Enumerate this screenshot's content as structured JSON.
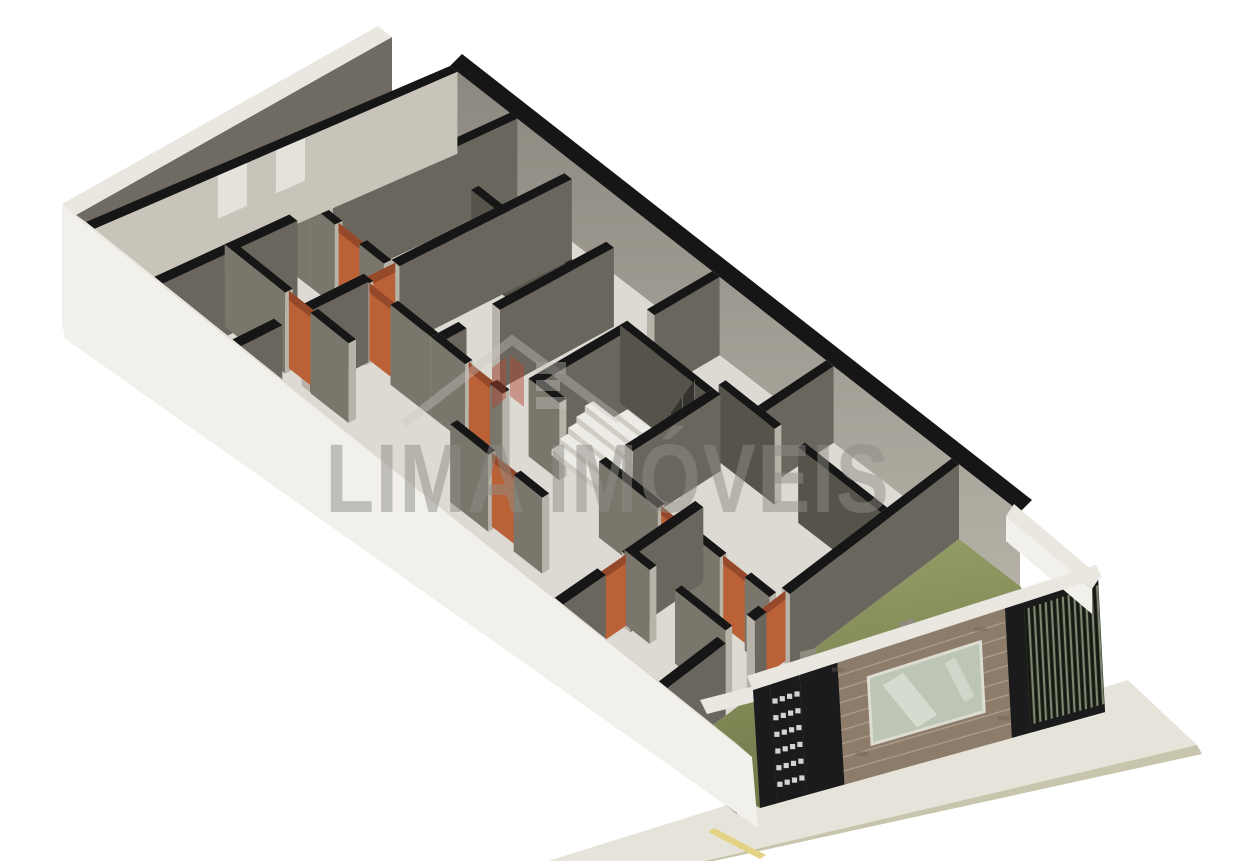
{
  "meta": {
    "description": "Isometric 3D architectural floor plan render of a long narrow building with interior walls, orange doors, central staircase, street-side garage facade with brick wall, slatted gate and sidewalk",
    "view": "isometric-3d-floor-plan"
  },
  "watermark": {
    "text": "LIMA IMÓVEIS",
    "logo": "house-logo",
    "x": 608,
    "y": 512,
    "size": 97,
    "text_length": 565
  },
  "colors": {
    "bg": "#ffffff",
    "wall_top": "#161616",
    "wall_face_dark": "#6a665d",
    "wall_face_med": "#7a766c",
    "wall_face_deep": "#56534b",
    "wall_face_light": "#c8c4ba",
    "wall_cap": "#b7b3a9",
    "ne_face_top": "#8d887f",
    "ne_face_bottom": "#b4b0a6",
    "floor": "#dcdad2",
    "side_yard": "#d5d3cb",
    "shell_band": "#e9e7e0",
    "shell_outer": "#f2f0ea",
    "shell_inner": "#6e6a61",
    "boundary_inner": "#6f6b63",
    "boundary_notch": "#e6e4dd",
    "door_orange": "#bb6138",
    "door_orange_dark": "#96492a",
    "stair_tread": "#edebe5",
    "stair_riser": "#cfccc4",
    "railing": "rgba(42,42,38,0.78)",
    "grass_light": "#9aa36b",
    "grass_dark": "#6e7747",
    "garage_band": "#e9e7e0",
    "garage_column": "#8f8b81",
    "brick_base": "#8d7c69",
    "brick_mortar": "#b7a897",
    "brick_dark": "#6f5f4e",
    "glass": "#ccd3c9",
    "glass_streak": "#f4f6f1",
    "window_frame": "#eff0ea",
    "facade_black": "#1b1b1e",
    "gate_bg": "#262b22",
    "gate_slat_light": "#7c856f",
    "gate_slat_dark": "#14180f",
    "walk_deck": "#e6e4da",
    "walk_curb": "#c7c5ab",
    "road_yellow": "#e2d386",
    "watermark_gray": "#8f8d87",
    "watermark_red": "#b14531",
    "watermark_light": "#c9c7c1"
  },
  "scene": {
    "projection": {
      "N": [
        450,
        66
      ],
      "E": [
        1020,
        512
      ],
      "W": [
        86,
        222
      ],
      "S": [
        737,
        744
      ],
      "hN": 82,
      "hE": 74,
      "hW": 84,
      "hS": 70
    },
    "shell": {
      "ne_band": [
        [
          462,
          54
        ],
        [
          1032,
          500
        ],
        [
          1020,
          512
        ],
        [
          450,
          66
        ]
      ],
      "boundary_band": [
        [
          62,
          204
        ],
        [
          378,
          26
        ],
        [
          392,
          37
        ],
        [
          76,
          215
        ]
      ],
      "boundary_face": [
        [
          76,
          215
        ],
        [
          392,
          37
        ],
        [
          392,
          121
        ],
        [
          76,
          299
        ]
      ],
      "boundary_notch": [
        [
          296,
          150
        ],
        [
          328,
          134
        ],
        [
          328,
          154
        ],
        [
          296,
          170
        ]
      ],
      "boundary_outer": [
        [
          62,
          204
        ],
        [
          76,
          215
        ],
        [
          76,
          299
        ],
        [
          62,
          331
        ]
      ],
      "side_yard": [
        [
          76,
          299
        ],
        [
          392,
          121
        ],
        [
          450,
          66
        ],
        [
          86,
          222
        ]
      ],
      "left_band": [
        [
          62,
          205
        ],
        [
          752,
          757
        ],
        [
          737,
          744
        ],
        [
          86,
          222
        ]
      ],
      "left_outer": [
        [
          62,
          205
        ],
        [
          752,
          757
        ],
        [
          758,
          828
        ],
        [
          64,
          338
        ]
      ]
    },
    "cross_walls": [
      {
        "s": 0.0,
        "t1": 0.0,
        "t2": 1.0,
        "w": 0.013,
        "shade": "light",
        "notches": [
          [
            0.42,
            0.5
          ],
          [
            0.58,
            0.66
          ]
        ]
      },
      {
        "s": 0.105,
        "t1": 0.0,
        "t2": 0.52,
        "w": 0.013,
        "shade": "dark"
      },
      {
        "s": 0.105,
        "t1": 0.62,
        "t2": 1.0,
        "w": 0.013,
        "shade": "dark"
      },
      {
        "s": 0.225,
        "t1": 0.04,
        "t2": 0.54,
        "w": 0.013,
        "shade": "dark"
      },
      {
        "s": 0.225,
        "t1": 0.63,
        "t2": 0.8,
        "w": 0.013,
        "shade": "dark"
      },
      {
        "s": 0.225,
        "t1": 0.88,
        "t2": 1.0,
        "w": 0.013,
        "shade": "dark"
      },
      {
        "s": 0.345,
        "t1": 0.12,
        "t2": 0.46,
        "w": 0.013,
        "shade": "dark"
      },
      {
        "s": 0.345,
        "t1": 0.56,
        "t2": 0.62,
        "w": 0.013,
        "shade": "dark"
      },
      {
        "s": 0.46,
        "t1": 0.0,
        "t2": 0.2,
        "w": 0.013,
        "shade": "dark"
      },
      {
        "s": 0.46,
        "t1": 0.26,
        "t2": 0.54,
        "w": 0.013,
        "shade": "dark"
      },
      {
        "s": 0.605,
        "t1": 0.26,
        "t2": 0.54,
        "w": 0.013,
        "shade": "dark"
      },
      {
        "s": 0.66,
        "t1": 0.0,
        "t2": 0.22,
        "w": 0.013,
        "shade": "dark"
      },
      {
        "s": 0.72,
        "t1": 0.54,
        "t2": 0.78,
        "w": 0.013,
        "shade": "dark"
      },
      {
        "s": 0.72,
        "t1": 0.86,
        "t2": 1.0,
        "w": 0.013,
        "shade": "dark"
      },
      {
        "s": 0.88,
        "t1": 0.0,
        "t2": 0.58,
        "w": 0.013,
        "shade": "dark"
      },
      {
        "s": 0.88,
        "t1": 0.66,
        "t2": 0.7,
        "w": 0.013,
        "shade": "dark"
      },
      {
        "s": 0.88,
        "t1": 0.8,
        "t2": 1.0,
        "w": 0.013,
        "shade": "dark"
      }
    ],
    "long_walls": [
      {
        "t": 0.22,
        "s1": 0.105,
        "s2": 0.145,
        "w": 0.022,
        "shade": "deep"
      },
      {
        "t": 0.22,
        "s1": 0.185,
        "s2": 0.345,
        "w": 0.022,
        "shade": "deep"
      },
      {
        "t": 0.26,
        "s1": 0.46,
        "s2": 0.605,
        "w": 0.022,
        "shade": "deep"
      },
      {
        "t": 0.22,
        "s1": 0.605,
        "s2": 0.7,
        "w": 0.022,
        "shade": "deep"
      },
      {
        "t": 0.22,
        "s1": 0.74,
        "s2": 0.88,
        "w": 0.022,
        "shade": "deep"
      },
      {
        "t": 0.54,
        "s1": 0.0,
        "s2": 0.105,
        "w": 0.022,
        "shade": "med"
      },
      {
        "t": 0.54,
        "s1": 0.105,
        "s2": 0.145,
        "w": 0.022,
        "shade": "med"
      },
      {
        "t": 0.54,
        "s1": 0.185,
        "s2": 0.225,
        "w": 0.022,
        "shade": "med"
      },
      {
        "t": 0.54,
        "s1": 0.46,
        "s2": 0.51,
        "w": 0.022,
        "shade": "med"
      },
      {
        "t": 0.62,
        "s1": 0.225,
        "s2": 0.24,
        "w": 0.022,
        "shade": "med"
      },
      {
        "t": 0.62,
        "s1": 0.28,
        "s2": 0.345,
        "w": 0.022,
        "shade": "med"
      },
      {
        "t": 0.62,
        "s1": 0.345,
        "s2": 0.4,
        "w": 0.022,
        "shade": "med"
      },
      {
        "t": 0.62,
        "s1": 0.44,
        "s2": 0.46,
        "w": 0.022,
        "shade": "med"
      },
      {
        "t": 0.6,
        "s1": 0.605,
        "s2": 0.7,
        "w": 0.022,
        "shade": "med"
      },
      {
        "t": 0.6,
        "s1": 0.74,
        "s2": 0.8,
        "w": 0.022,
        "shade": "med"
      },
      {
        "t": 0.6,
        "s1": 0.84,
        "s2": 0.88,
        "w": 0.022,
        "shade": "med"
      },
      {
        "t": 0.78,
        "s1": 0.105,
        "s2": 0.2,
        "w": 0.022,
        "shade": "med"
      },
      {
        "t": 0.78,
        "s1": 0.24,
        "s2": 0.3,
        "w": 0.022,
        "shade": "med"
      },
      {
        "t": 0.78,
        "s1": 0.46,
        "s2": 0.52,
        "w": 0.022,
        "shade": "med"
      },
      {
        "t": 0.78,
        "s1": 0.56,
        "s2": 0.605,
        "w": 0.022,
        "shade": "med"
      },
      {
        "t": 0.75,
        "s1": 0.72,
        "s2": 0.76,
        "w": 0.022,
        "shade": "med"
      },
      {
        "t": 0.75,
        "s1": 0.8,
        "s2": 0.88,
        "w": 0.022,
        "shade": "med"
      }
    ],
    "doors": [
      {
        "kind": "long",
        "t": 0.54,
        "a1": 0.145,
        "a2": 0.185
      },
      {
        "kind": "cross",
        "s": 0.225,
        "a1": 0.54,
        "a2": 0.63
      },
      {
        "kind": "long",
        "t": 0.62,
        "a1": 0.24,
        "a2": 0.28
      },
      {
        "kind": "long",
        "t": 0.62,
        "a1": 0.4,
        "a2": 0.44
      },
      {
        "kind": "long",
        "t": 0.78,
        "a1": 0.2,
        "a2": 0.24
      },
      {
        "kind": "long",
        "t": 0.78,
        "a1": 0.52,
        "a2": 0.56
      },
      {
        "kind": "long",
        "t": 0.6,
        "a1": 0.7,
        "a2": 0.74
      },
      {
        "kind": "long",
        "t": 0.6,
        "a1": 0.8,
        "a2": 0.84
      },
      {
        "kind": "cross",
        "s": 0.72,
        "a1": 0.78,
        "a2": 0.86
      },
      {
        "kind": "cross",
        "s": 0.88,
        "a1": 0.58,
        "a2": 0.66
      }
    ],
    "stairs": {
      "s1": 0.475,
      "s2": 0.59,
      "tb": 0.52,
      "tt": 0.29,
      "steps": 9,
      "rise": 54
    },
    "garage": {
      "grass": [
        [
          959,
          539
        ],
        [
          1020,
          586
        ],
        [
          1105,
          712
        ],
        [
          760,
          808
        ],
        [
          667,
          760
        ]
      ],
      "inner_band": [
        [
          700,
          700
        ],
        [
          1005,
          622
        ],
        [
          1012,
          636
        ],
        [
          707,
          714
        ]
      ],
      "columns": [
        [
          [
            800,
            652
          ],
          [
            816,
            648
          ],
          [
            816,
            712
          ],
          [
            800,
            716
          ]
        ],
        [
          [
            900,
            622
          ],
          [
            914,
            618
          ],
          [
            914,
            682
          ],
          [
            900,
            686
          ]
        ]
      ]
    },
    "facade": {
      "top1": [
        753,
        690
      ],
      "top2": [
        1098,
        577
      ],
      "h1": 118,
      "h2": 135,
      "dx": 7,
      "segments": [
        {
          "f1": 0.0,
          "f2": 0.05,
          "kind": "black"
        },
        {
          "f1": 0.05,
          "f2": 0.135,
          "kind": "cobogo"
        },
        {
          "f1": 0.135,
          "f2": 0.245,
          "kind": "black"
        },
        {
          "f1": 0.245,
          "f2": 0.73,
          "kind": "brick",
          "window": {
            "f1": 0.33,
            "f2": 0.655,
            "v1": 0.2,
            "v2": 0.74
          }
        },
        {
          "f1": 0.73,
          "f2": 0.785,
          "kind": "black"
        },
        {
          "f1": 0.785,
          "f2": 1.0,
          "kind": "gate"
        }
      ],
      "band": [
        [
          747,
          676
        ],
        [
          1096,
          565
        ],
        [
          1102,
          577
        ],
        [
          753,
          690
        ]
      ],
      "ne_band": [
        [
          1014,
          504
        ],
        [
          1100,
          577
        ],
        [
          1092,
          589
        ],
        [
          1006,
          516
        ]
      ],
      "ne_face": [
        [
          1006,
          516
        ],
        [
          1092,
          589
        ],
        [
          1092,
          614
        ],
        [
          1006,
          541
        ]
      ]
    },
    "sidewalk": {
      "deck": [
        [
          1128,
          680
        ],
        [
          1197,
          745
        ],
        [
          705,
          861
        ],
        [
          548,
          861
        ]
      ],
      "curb": [
        [
          1197,
          745
        ],
        [
          1202,
          754
        ],
        [
          714,
          861
        ],
        [
          705,
          861
        ]
      ],
      "yellow_line": [
        [
          714,
          828
        ],
        [
          766,
          855
        ],
        [
          760,
          859
        ],
        [
          708,
          832
        ]
      ]
    }
  }
}
